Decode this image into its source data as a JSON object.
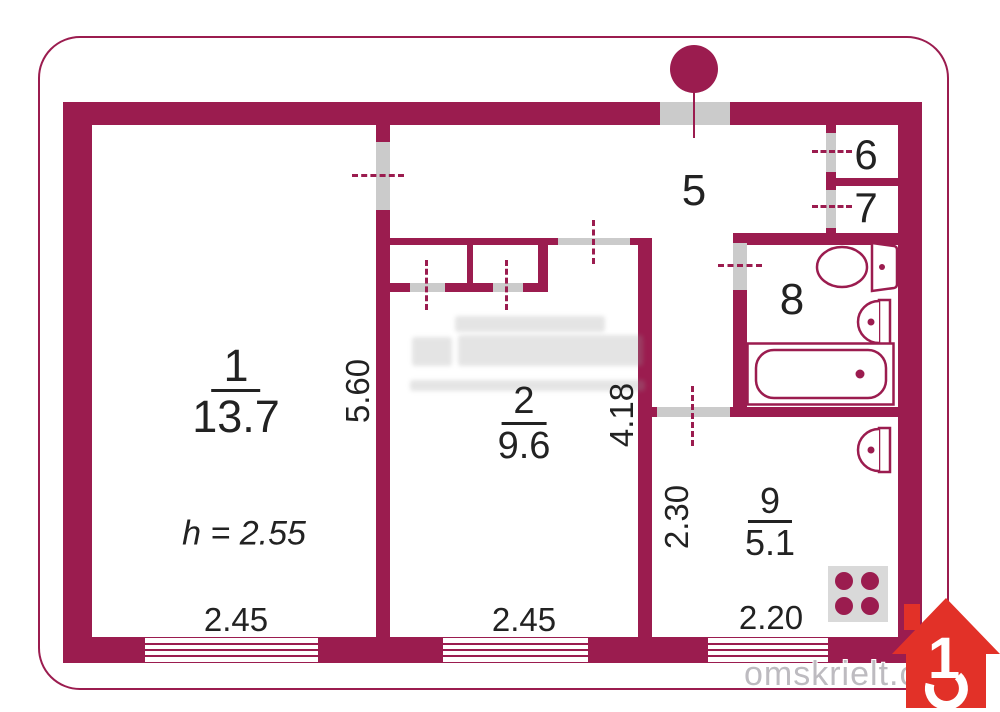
{
  "rooms": {
    "room1": {
      "number": "1",
      "area": "13.7"
    },
    "room2": {
      "number": "2",
      "area": "9.6"
    },
    "hall": {
      "number": "5"
    },
    "closet6": {
      "number": "6"
    },
    "closet7": {
      "number": "7"
    },
    "bathroom": {
      "number": "8"
    },
    "kitchen": {
      "number": "9",
      "area": "5.1"
    }
  },
  "dimensions": {
    "ceiling_height": "h = 2.55",
    "room1_width": "2.45",
    "room1_depth": "5.60",
    "room2_width": "2.45",
    "room2_depth": "4.18",
    "kitchen_depth": "2.30",
    "kitchen_width": "2.20"
  },
  "fixtures": [
    "toilet",
    "sink-bathroom",
    "bathtub",
    "sink-kitchen",
    "stove",
    "entrance-door-marker"
  ],
  "branding": {
    "watermark": "omskrielt.com",
    "logo_digit": "1"
  },
  "colors": {
    "wall": "#9b1c4f",
    "door_opening": "#cbcbcb",
    "logo_red": "#e23128",
    "watermark_gray": "#bdbbc0",
    "stove_gray": "#d9d9d9"
  }
}
